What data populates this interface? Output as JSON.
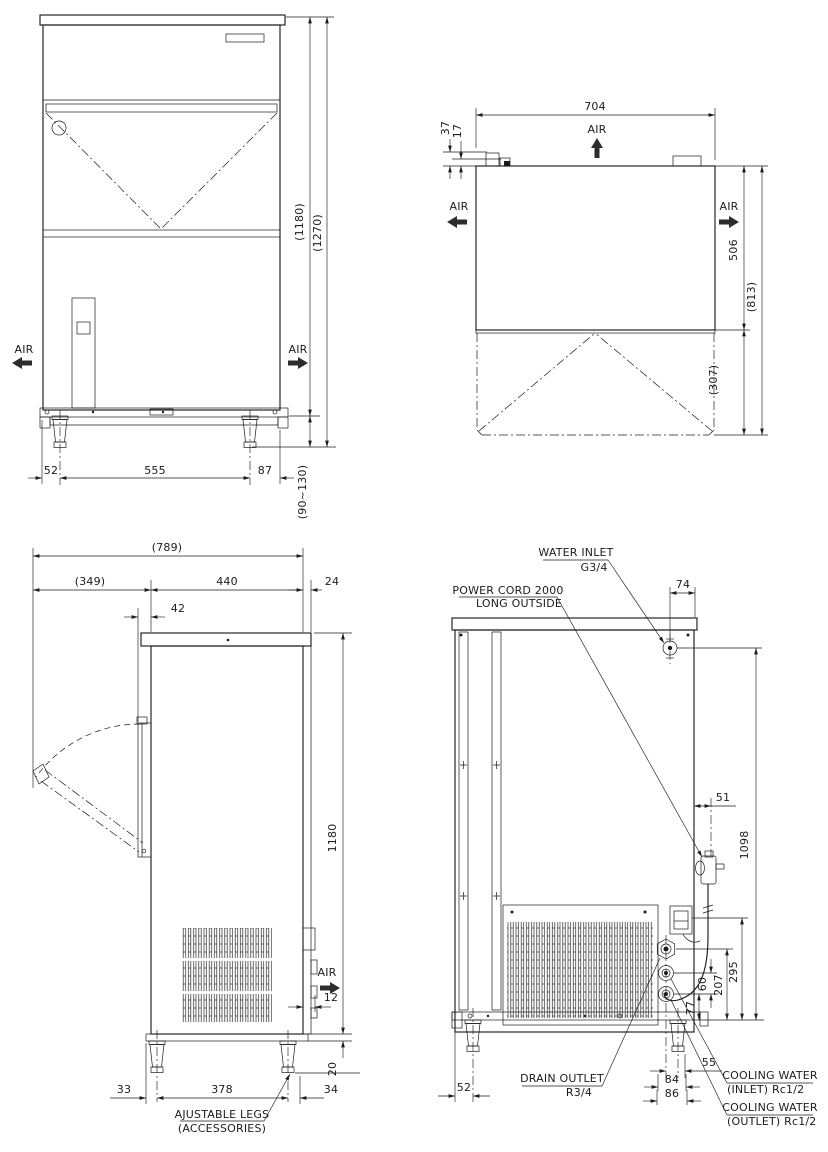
{
  "drawing": {
    "type": "technical-dimension-drawing",
    "subject": "ice machine 4-view outline drawing",
    "line_color": "#1c1c1c",
    "background": "#ffffff"
  },
  "views": {
    "front": {
      "air_left": "AIR",
      "air_right": "AIR",
      "dims": {
        "base_left": "52",
        "leg_span": "555",
        "base_right": "87",
        "body_height": "(1180)",
        "total_height": "(1270)",
        "leg_range": "(90~130)"
      }
    },
    "top": {
      "air_top": "AIR",
      "air_left": "AIR",
      "air_right": "AIR",
      "dims": {
        "width": "704",
        "fitting_a": "37",
        "fitting_b": "17",
        "depth": "506",
        "depth_total": "(813)",
        "door_swing": "(307)"
      }
    },
    "side": {
      "air": "AIR",
      "legs_note_line1": "AJUSTABLE LEGS",
      "legs_note_line2": "(ACCESSORIES)",
      "dims": {
        "depth_total": "(789)",
        "door_swing": "(349)",
        "body_depth": "440",
        "rear_offset": "24",
        "door_thickness": "42",
        "height": "1180",
        "vent": "12",
        "base": "20",
        "front_leg": "33",
        "leg_span": "378",
        "rear_leg": "34"
      }
    },
    "rear": {
      "labels": {
        "water_inlet_line1": "WATER INLET",
        "water_inlet_line2": "G3/4",
        "power_cord_line1": "POWER CORD 2000",
        "power_cord_line2": "LONG OUTSIDE",
        "drain_line1": "DRAIN OUTLET",
        "drain_line2": "R3/4",
        "cooling_inlet_line1": "COOLING WATER",
        "cooling_inlet_line2": "(INLET) Rc1/2",
        "cooling_outlet_line1": "COOLING WATER",
        "cooling_outlet_line2": "(OUTLET) Rc1/2"
      },
      "dims": {
        "inlet_offset": "74",
        "cord_offset": "51",
        "inlet_height": "1098",
        "cord_height": "295",
        "drain_height": "207",
        "cooling_gap": "60",
        "outlet_height": "77",
        "leg_offset": "52",
        "cord_span": "55",
        "fitting_span": "84",
        "fitting_span2": "86"
      }
    }
  }
}
